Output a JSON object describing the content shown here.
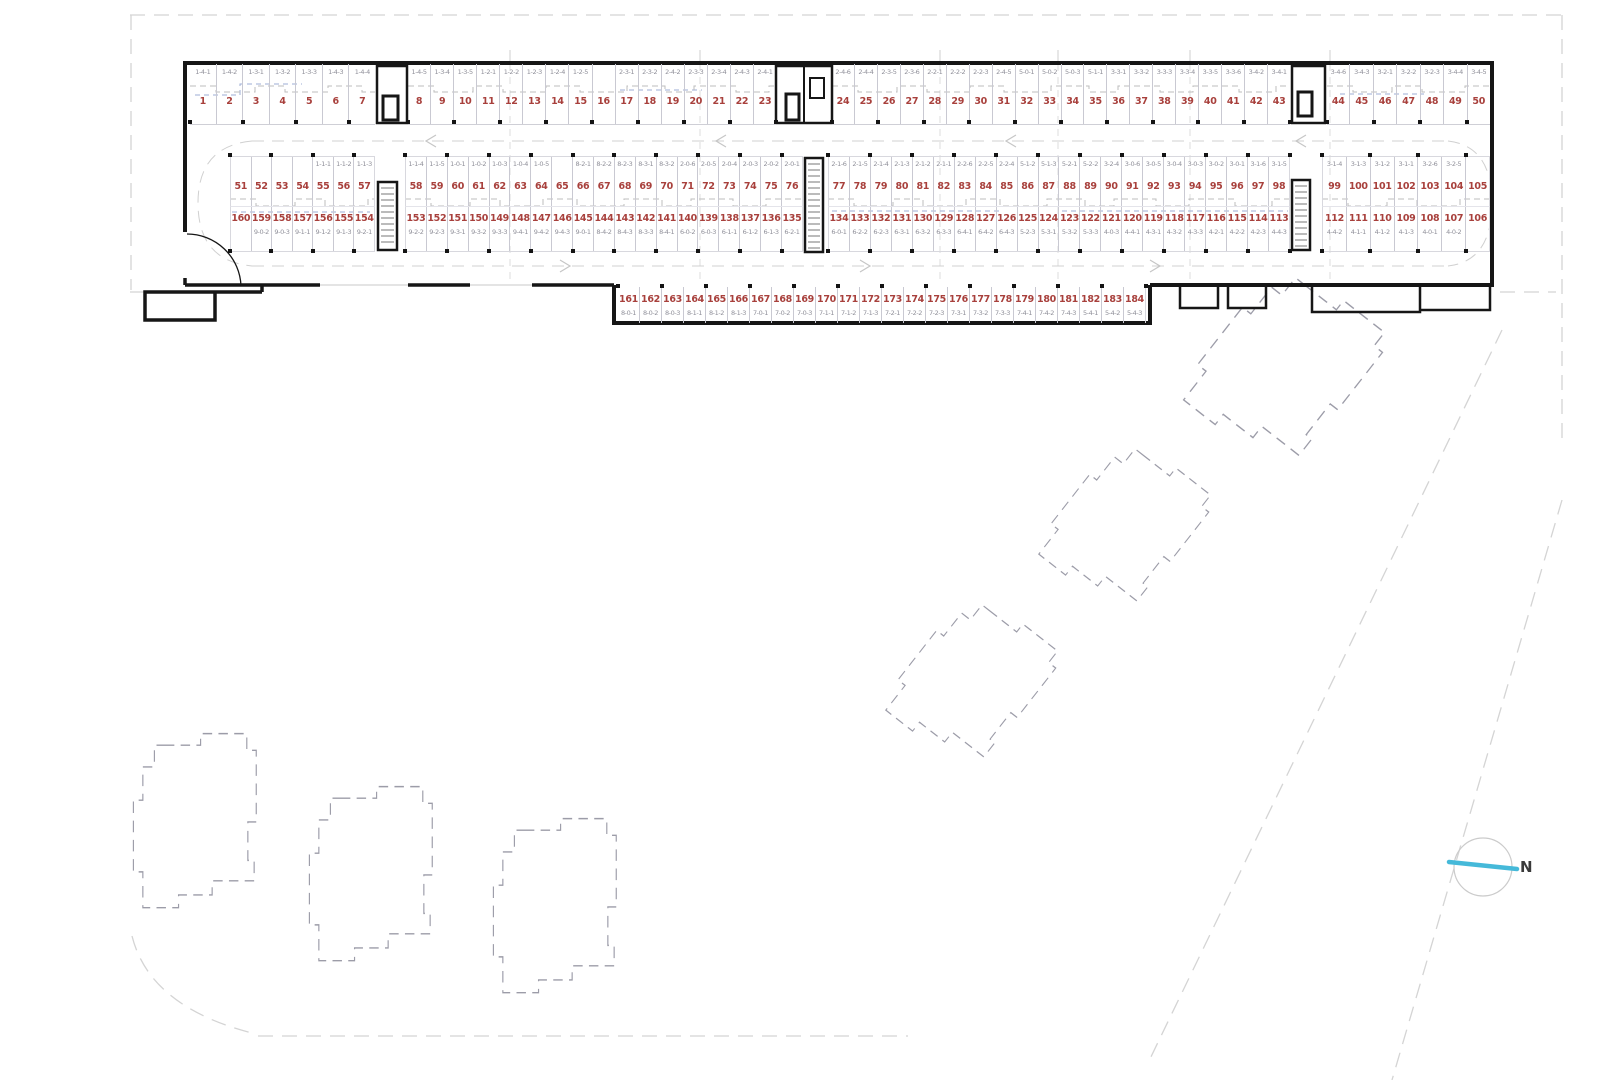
{
  "plan": {
    "title": "underground-parking-floor-plan",
    "north_label": "N",
    "row1_groups": [
      [
        [
          "1",
          "1-4-1"
        ],
        [
          "2",
          "1-4-2"
        ],
        [
          "3",
          "1-3-1"
        ],
        [
          "4",
          "1-3-2"
        ],
        [
          "5",
          "1-3-3"
        ],
        [
          "6",
          "1-4-3"
        ],
        [
          "7",
          "1-4-4"
        ]
      ],
      [
        [
          "8",
          "1-4-5"
        ],
        [
          "9",
          "1-3-4"
        ],
        [
          "10",
          "1-3-5"
        ],
        [
          "11",
          "1-2-1"
        ],
        [
          "12",
          "1-2-2"
        ],
        [
          "13",
          "1-2-3"
        ],
        [
          "14",
          "1-2-4"
        ],
        [
          "15",
          "1-2-5"
        ],
        [
          "16",
          ""
        ],
        [
          "17",
          "2-3-1"
        ],
        [
          "18",
          "2-3-2"
        ],
        [
          "19",
          "2-4-2"
        ],
        [
          "20",
          "2-3-3"
        ],
        [
          "21",
          "2-3-4"
        ],
        [
          "22",
          "2-4-3"
        ],
        [
          "23",
          "2-4-1"
        ]
      ],
      [
        [
          "24",
          "2-4-6"
        ],
        [
          "25",
          "2-4-4"
        ],
        [
          "26",
          "2-3-5"
        ],
        [
          "27",
          "2-3-6"
        ],
        [
          "28",
          "2-2-1"
        ],
        [
          "29",
          "2-2-2"
        ],
        [
          "30",
          "2-2-3"
        ],
        [
          "31",
          "2-4-5"
        ],
        [
          "32",
          "5-0-1"
        ],
        [
          "33",
          "5-0-2"
        ],
        [
          "34",
          "5-0-3"
        ],
        [
          "35",
          "5-1-1"
        ],
        [
          "36",
          "3-3-1"
        ],
        [
          "37",
          "3-3-2"
        ],
        [
          "38",
          "3-3-3"
        ],
        [
          "39",
          "3-3-4"
        ],
        [
          "40",
          "3-3-5"
        ],
        [
          "41",
          "3-3-6"
        ],
        [
          "42",
          "3-4-2"
        ],
        [
          "43",
          "3-4-1"
        ]
      ],
      [
        [
          "44",
          "3-4-6"
        ],
        [
          "45",
          "3-4-3"
        ],
        [
          "46",
          "3-2-1"
        ],
        [
          "47",
          "3-2-2"
        ],
        [
          "48",
          "3-2-3"
        ],
        [
          "49",
          "3-4-4"
        ],
        [
          "50",
          "3-4-5"
        ]
      ]
    ],
    "row2_groups": [
      [
        [
          "51",
          ""
        ],
        [
          "52",
          ""
        ],
        [
          "53",
          ""
        ],
        [
          "54",
          ""
        ],
        [
          "55",
          "1-1-1"
        ],
        [
          "56",
          "1-1-2"
        ],
        [
          "57",
          "1-1-3"
        ]
      ],
      [
        [
          "58",
          "1-1-4"
        ],
        [
          "59",
          "1-1-5"
        ],
        [
          "60",
          "1-0-1"
        ],
        [
          "61",
          "1-0-2"
        ],
        [
          "62",
          "1-0-3"
        ],
        [
          "63",
          "1-0-4"
        ],
        [
          "64",
          "1-0-5"
        ],
        [
          "65",
          ""
        ],
        [
          "66",
          "8-2-1"
        ],
        [
          "67",
          "8-2-2"
        ],
        [
          "68",
          "8-2-3"
        ],
        [
          "69",
          "8-3-1"
        ],
        [
          "70",
          "8-3-2"
        ],
        [
          "71",
          "2-0-6"
        ],
        [
          "72",
          "2-0-5"
        ],
        [
          "73",
          "2-0-4"
        ],
        [
          "74",
          "2-0-3"
        ],
        [
          "75",
          "2-0-2"
        ],
        [
          "76",
          "2-0-1"
        ]
      ],
      [
        [
          "77",
          "2-1-6"
        ],
        [
          "78",
          "2-1-5"
        ],
        [
          "79",
          "2-1-4"
        ],
        [
          "80",
          "2-1-3"
        ],
        [
          "81",
          "2-1-2"
        ],
        [
          "82",
          "2-1-1"
        ],
        [
          "83",
          "2-2-6"
        ],
        [
          "84",
          "2-2-5"
        ],
        [
          "85",
          "2-2-4"
        ],
        [
          "86",
          "5-1-2"
        ],
        [
          "87",
          "5-1-3"
        ],
        [
          "88",
          "5-2-1"
        ],
        [
          "89",
          "5-2-2"
        ],
        [
          "90",
          "3-2-4"
        ],
        [
          "91",
          "3-0-6"
        ],
        [
          "92",
          "3-0-5"
        ],
        [
          "93",
          "3-0-4"
        ],
        [
          "94",
          "3-0-3"
        ],
        [
          "95",
          "3-0-2"
        ],
        [
          "96",
          "3-0-1"
        ],
        [
          "97",
          "3-1-6"
        ],
        [
          "98",
          "3-1-5"
        ]
      ],
      [
        [
          "99",
          "3-1-4"
        ],
        [
          "100",
          "3-1-3"
        ],
        [
          "101",
          "3-1-2"
        ],
        [
          "102",
          "3-1-1"
        ],
        [
          "103",
          "3-2-6"
        ],
        [
          "104",
          "3-2-5"
        ],
        [
          "105",
          ""
        ]
      ]
    ],
    "row3_groups": [
      [
        [
          "160",
          ""
        ],
        [
          "159",
          "9-0-2"
        ],
        [
          "158",
          "9-0-3"
        ],
        [
          "157",
          "9-1-1"
        ],
        [
          "156",
          "9-1-2"
        ],
        [
          "155",
          "9-1-3"
        ],
        [
          "154",
          "9-2-1"
        ]
      ],
      [
        [
          "153",
          "9-2-2"
        ],
        [
          "152",
          "9-2-3"
        ],
        [
          "151",
          "9-3-1"
        ],
        [
          "150",
          "9-3-2"
        ],
        [
          "149",
          "9-3-3"
        ],
        [
          "148",
          "9-4-1"
        ],
        [
          "147",
          "9-4-2"
        ],
        [
          "146",
          "9-4-3"
        ],
        [
          "145",
          "9-0-1"
        ],
        [
          "144",
          "8-4-2"
        ],
        [
          "143",
          "8-4-3"
        ],
        [
          "142",
          "8-3-3"
        ],
        [
          "141",
          "8-4-1"
        ],
        [
          "140",
          "6-0-2"
        ],
        [
          "139",
          "6-0-3"
        ],
        [
          "138",
          "6-1-1"
        ],
        [
          "137",
          "6-1-2"
        ],
        [
          "136",
          "6-1-3"
        ],
        [
          "135",
          "6-2-1"
        ]
      ],
      [
        [
          "134",
          "6-0-1"
        ],
        [
          "133",
          "6-2-2"
        ],
        [
          "132",
          "6-2-3"
        ],
        [
          "131",
          "6-3-1"
        ],
        [
          "130",
          "6-3-2"
        ],
        [
          "129",
          "6-3-3"
        ],
        [
          "128",
          "6-4-1"
        ],
        [
          "127",
          "6-4-2"
        ],
        [
          "126",
          "6-4-3"
        ],
        [
          "125",
          "5-2-3"
        ],
        [
          "124",
          "5-3-1"
        ],
        [
          "123",
          "5-3-2"
        ],
        [
          "122",
          "5-3-3"
        ],
        [
          "121",
          "4-0-3"
        ],
        [
          "120",
          "4-4-1"
        ],
        [
          "119",
          "4-3-1"
        ],
        [
          "118",
          "4-3-2"
        ],
        [
          "117",
          "4-3-3"
        ],
        [
          "116",
          "4-2-1"
        ],
        [
          "115",
          "4-2-2"
        ],
        [
          "114",
          "4-2-3"
        ],
        [
          "113",
          "4-4-3"
        ]
      ],
      [
        [
          "112",
          "4-4-2"
        ],
        [
          "111",
          "4-1-1"
        ],
        [
          "110",
          "4-1-2"
        ],
        [
          "109",
          "4-1-3"
        ],
        [
          "108",
          "4-0-1"
        ],
        [
          "107",
          "4-0-2"
        ],
        [
          "106",
          ""
        ]
      ]
    ],
    "row4_groups": [
      [
        [
          "161",
          "8-0-1"
        ],
        [
          "162",
          "8-0-2"
        ],
        [
          "163",
          "8-0-3"
        ],
        [
          "164",
          "8-1-1"
        ],
        [
          "165",
          "8-1-2"
        ],
        [
          "166",
          "8-1-3"
        ],
        [
          "167",
          "7-0-1"
        ],
        [
          "168",
          "7-0-2"
        ],
        [
          "169",
          "7-0-3"
        ],
        [
          "170",
          "7-1-1"
        ],
        [
          "171",
          "7-1-2"
        ],
        [
          "172",
          "7-1-3"
        ],
        [
          "173",
          "7-2-1"
        ],
        [
          "174",
          "7-2-2"
        ],
        [
          "175",
          "7-2-3"
        ],
        [
          "176",
          "7-3-1"
        ],
        [
          "177",
          "7-3-2"
        ],
        [
          "178",
          "7-3-3"
        ],
        [
          "179",
          "7-4-1"
        ],
        [
          "180",
          "7-4-2"
        ],
        [
          "181",
          "7-4-3"
        ],
        [
          "182",
          "5-4-1"
        ],
        [
          "183",
          "5-4-2"
        ],
        [
          "184",
          "5-4-3"
        ]
      ]
    ],
    "colors": {
      "stall_number": "#a8403c",
      "stall_code": "#90909a",
      "wall": "#161616",
      "north_line": "#45b9d9",
      "future_building_dash": "#9c9ca8"
    }
  }
}
